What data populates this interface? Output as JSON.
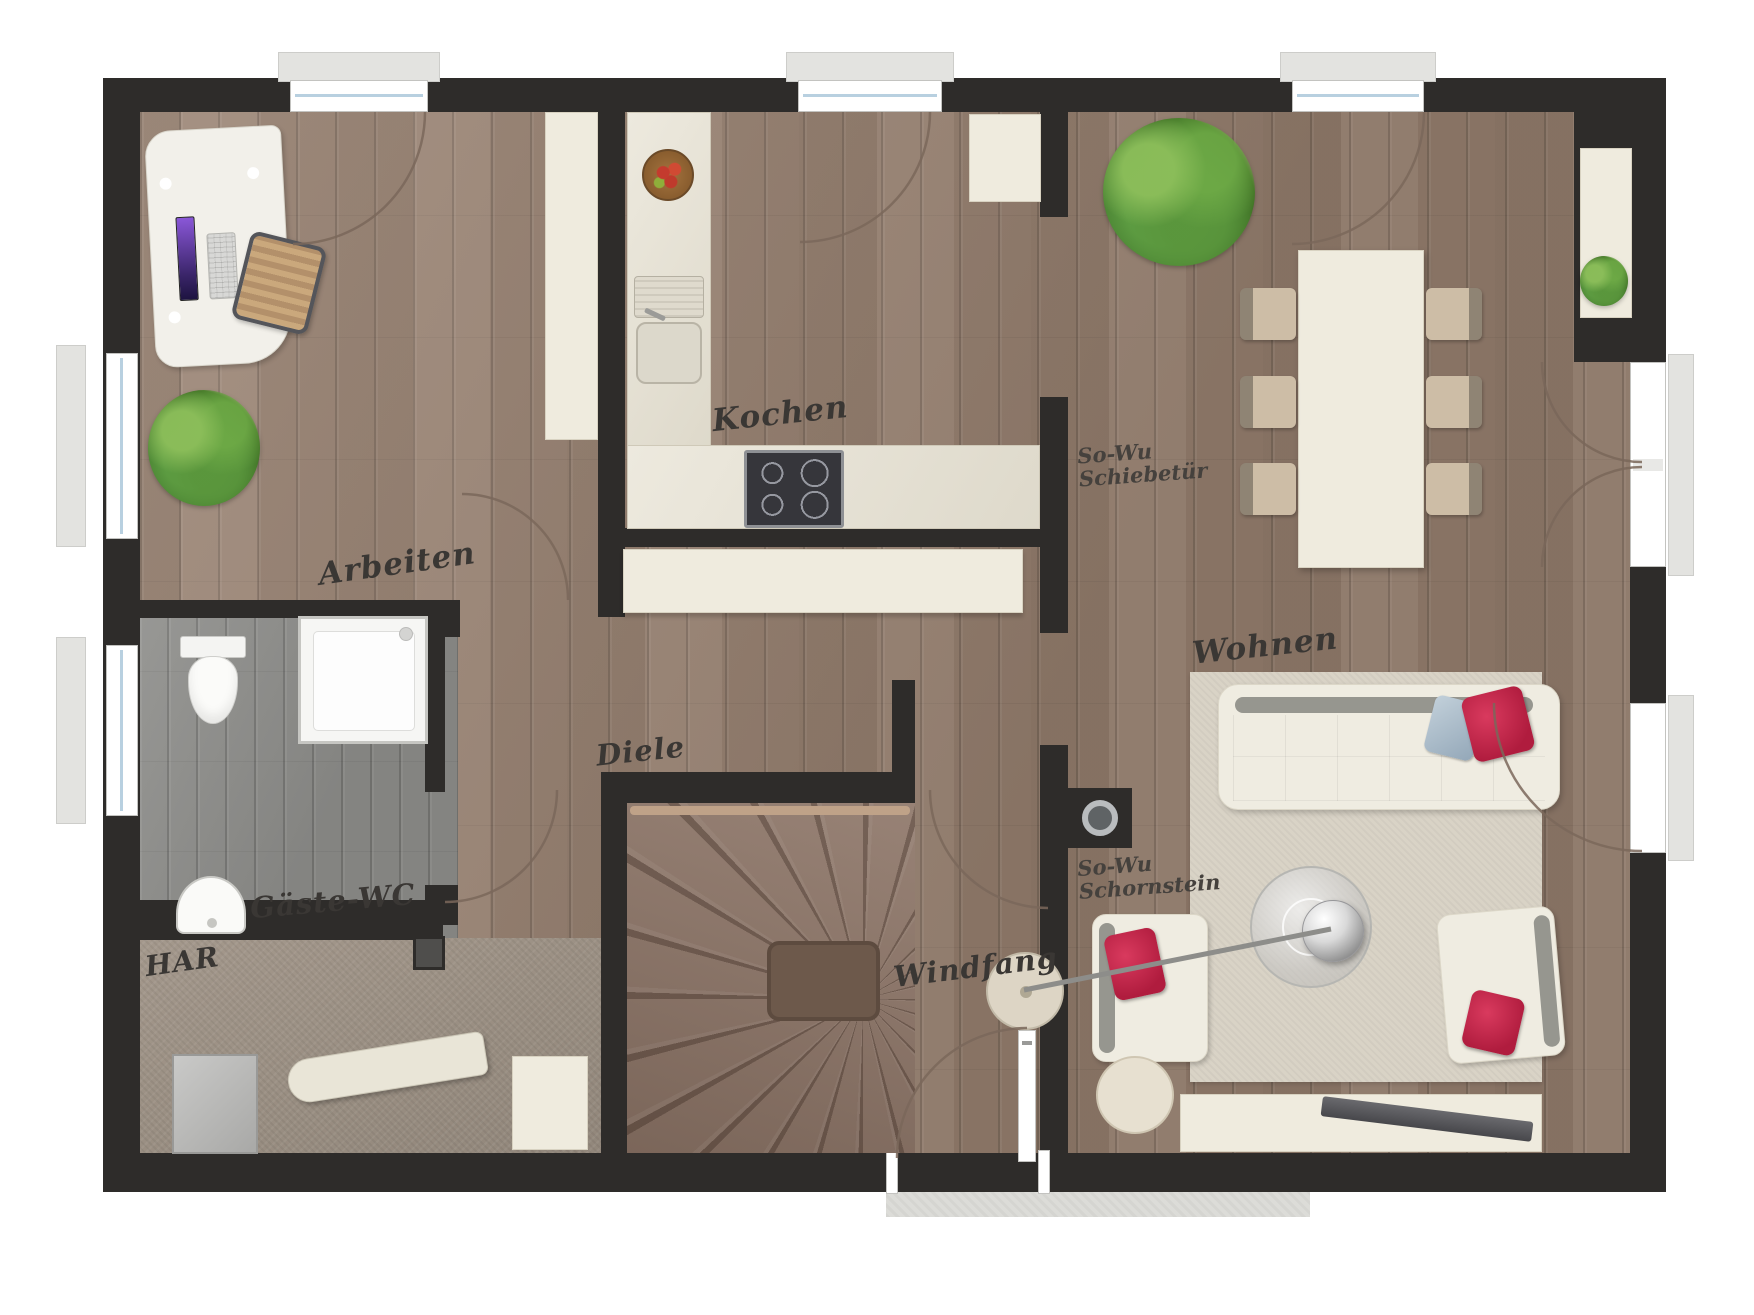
{
  "title": "Erdgeschoss Grundriss",
  "colors": {
    "wall": "#2e2c2a",
    "wood": "#97806f",
    "carpet": "#9e9285",
    "cream": "#efebde",
    "counter": "#e7e2d3",
    "rug": "#d9d3c6",
    "tile": "#dcdcd8",
    "accent-red": "#c3264a",
    "plant-green": "#5d9c42"
  },
  "rooms": {
    "arbeiten": {
      "label": "Arbeiten"
    },
    "kochen": {
      "label": "Kochen"
    },
    "diele": {
      "label": "Diele"
    },
    "gaeste_wc": {
      "label": "Gäste-WC"
    },
    "har": {
      "label": "HAR"
    },
    "windfang": {
      "label": "Windfang"
    },
    "wohnen": {
      "label": "Wohnen"
    }
  },
  "annotations": {
    "schiebetuer": {
      "line1": "So-Wu",
      "line2": "Schiebetür"
    },
    "schornstein": {
      "line1": "So-Wu",
      "line2": "Schornstein"
    }
  }
}
